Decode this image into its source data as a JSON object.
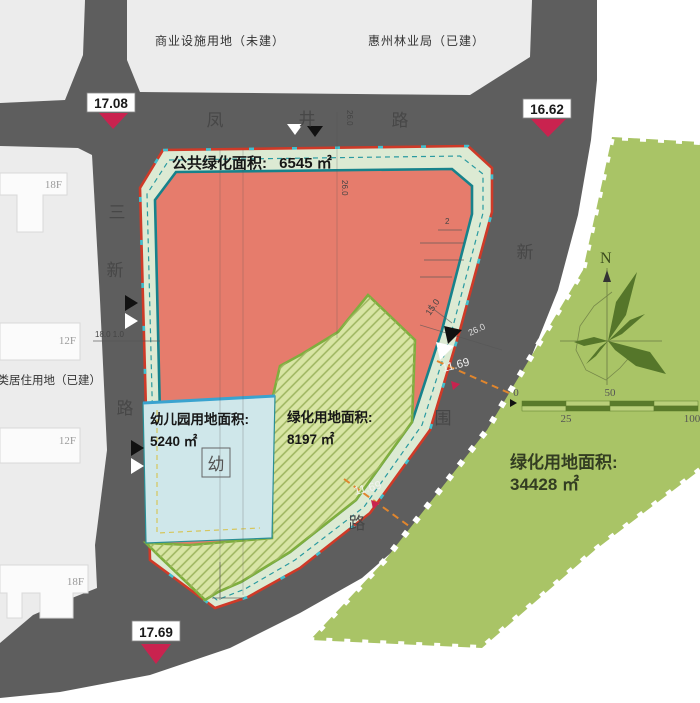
{
  "map": {
    "blocks": {
      "commercial": "商业设施用地（未建）",
      "forestry": "惠州林业局（已建）",
      "residential": "二类居住用地（已建）"
    },
    "buildings": [
      {
        "floors": "18F"
      },
      {
        "floors": "12F"
      },
      {
        "floors": "12F"
      },
      {
        "floors": "18F"
      }
    ],
    "roads": {
      "top": [
        "凤",
        "井",
        "路"
      ],
      "left": [
        "三",
        "新",
        "路"
      ],
      "arc": [
        "新",
        "围",
        "路"
      ]
    },
    "elevations": [
      {
        "value": "17.08"
      },
      {
        "value": "16.62"
      },
      {
        "value": "17.69"
      }
    ],
    "parcels": {
      "public_green": {
        "label": "公共绿化面积:",
        "area": "6545 ㎡"
      },
      "kindergarten": {
        "label": "幼儿园用地面积:",
        "area": "5240 ㎡",
        "marker": "幼"
      },
      "green": {
        "label": "绿化用地面积:",
        "area": "8197 ㎡"
      },
      "big_green": {
        "label": "绿化用地面积:",
        "area": "34428 ㎡"
      }
    },
    "dims": {
      "road_top_width": "26.0",
      "inner_width": "26.0",
      "left_chain": "18.0 1.0",
      "edge_width": "15.0",
      "road_right_width": "26.0",
      "setback1": "11.69",
      "setback2": "11.69",
      "note2": "2"
    },
    "compass": {
      "north": "N"
    },
    "scale": {
      "t0": "0",
      "t25": "25",
      "t50": "50",
      "t100": "100"
    },
    "colors": {
      "road": "#5e5e5e",
      "block": "#ececec",
      "parcel_red": "#e67c6c",
      "band_green": "#dcead3",
      "teal": "#17828b",
      "red_line": "#cf3a28",
      "blue_fill": "#cfe7ea",
      "blue_line": "#3aa3cf",
      "hatch_fill": "#d8e5a5",
      "hatch_border": "#7fae3e",
      "big_green": "#a9c466",
      "dark_green": "#55762a",
      "orange_dash": "#e0862e",
      "crimson": "#c9234f"
    }
  }
}
